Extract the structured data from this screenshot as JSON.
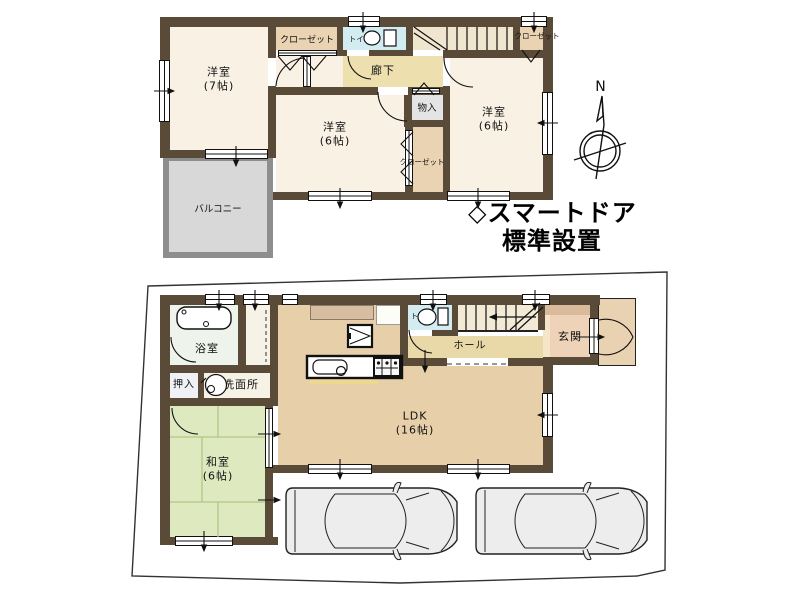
{
  "annotation": {
    "line1": "◇スマートドア",
    "line2": "標準設置"
  },
  "compass": {
    "label": "N"
  },
  "floor2": {
    "rooms": {
      "yoshitsu7": {
        "name": "洋室",
        "size": "(7帖)"
      },
      "closet_top": {
        "name": "クローゼット"
      },
      "toilet": {
        "name": "トイレ"
      },
      "closet_topright": {
        "name": "クローゼット"
      },
      "rouka": {
        "name": "廊下"
      },
      "monoire": {
        "name": "物入"
      },
      "yoshitsu6_center": {
        "name": "洋室",
        "size": "(6帖)"
      },
      "closet_mid": {
        "name": "クローゼット"
      },
      "yoshitsu6_right": {
        "name": "洋室",
        "size": "(6帖)"
      },
      "balcony": {
        "name": "バルコニー"
      }
    }
  },
  "floor1": {
    "rooms": {
      "bath": {
        "name": "浴室"
      },
      "oshiire": {
        "name": "押入"
      },
      "washroom": {
        "name": "洗面所"
      },
      "washitsu": {
        "name": "和室",
        "size": "(6帖)"
      },
      "ldk": {
        "name": "LDK",
        "size": "(16帖)"
      },
      "toilet": {
        "name": "トイレ"
      },
      "hall": {
        "name": "ホール"
      },
      "genkan": {
        "name": "玄関"
      }
    }
  },
  "colors": {
    "wall": "#5a4a38",
    "room_cream": "#f8f1e4",
    "closet_tan": "#e9d3b2",
    "corridor_yellow": "#eddfae",
    "toilet_blue": "#d2ecf2",
    "storage_gray": "#e4e4e4",
    "balcony_gray": "#d8d8d8",
    "bath_green": "#eef3ec",
    "tatami_green": "#dfe9c0",
    "tatami_line": "#b3c687",
    "ldk_tan": "#e7cfa9",
    "genkan_pink": "#eed3b8",
    "porch_tan": "#e9d2b2",
    "car_gray": "#ededed",
    "text": "#111111"
  }
}
